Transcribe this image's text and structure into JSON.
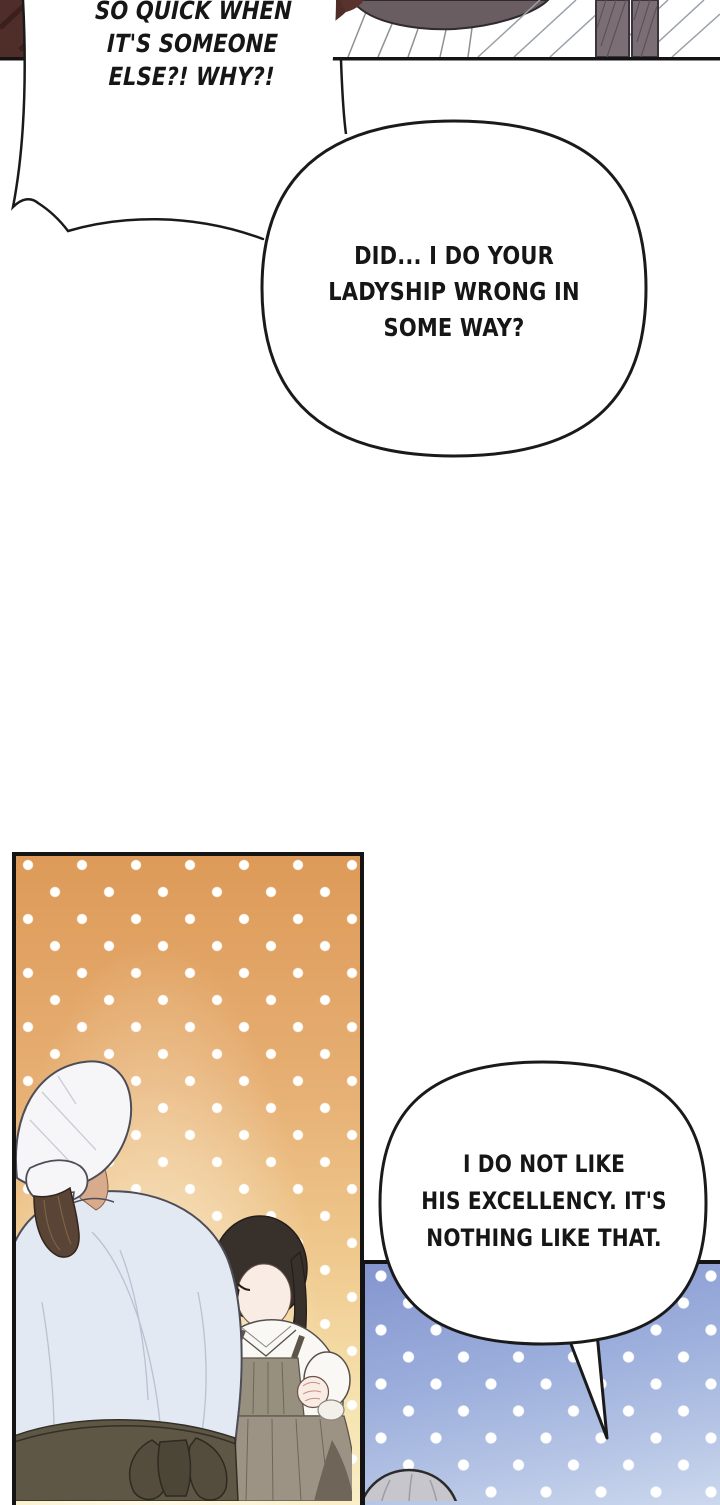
{
  "bubbles": {
    "shout": {
      "lines": [
        "SO QUICK WHEN",
        "IT'S SOMEONE",
        "ELSE?! WHY?!"
      ]
    },
    "question": {
      "lines": [
        "DID... I DO YOUR",
        "LADYSHIP WRONG IN",
        "SOME WAY?"
      ]
    },
    "denial": {
      "lines": [
        "I DO NOT LIKE",
        "HIS EXCELLENCY. IT'S",
        "NOTHING LIKE THAT."
      ]
    }
  },
  "colors": {
    "ink": "#141414",
    "bubble_fill": "#ffffff",
    "wood_floor": "#4f2e2a",
    "panel_orange_top": "#dd9a58",
    "panel_orange_bottom": "#f9eec7",
    "panel_blue_top": "#8495cf",
    "panel_blue_bottom": "#ccd8ee",
    "polka_dot": "#ffffff",
    "kerchief_white": "#f6f6f8",
    "cook_shirt": "#e3e9f2",
    "apron_olive": "#5e5746",
    "lady_hair": "#38302b",
    "pinafore_gray": "#98907e",
    "skin": "#f9ece5",
    "silhouette_gray": "#c6c6cc"
  }
}
